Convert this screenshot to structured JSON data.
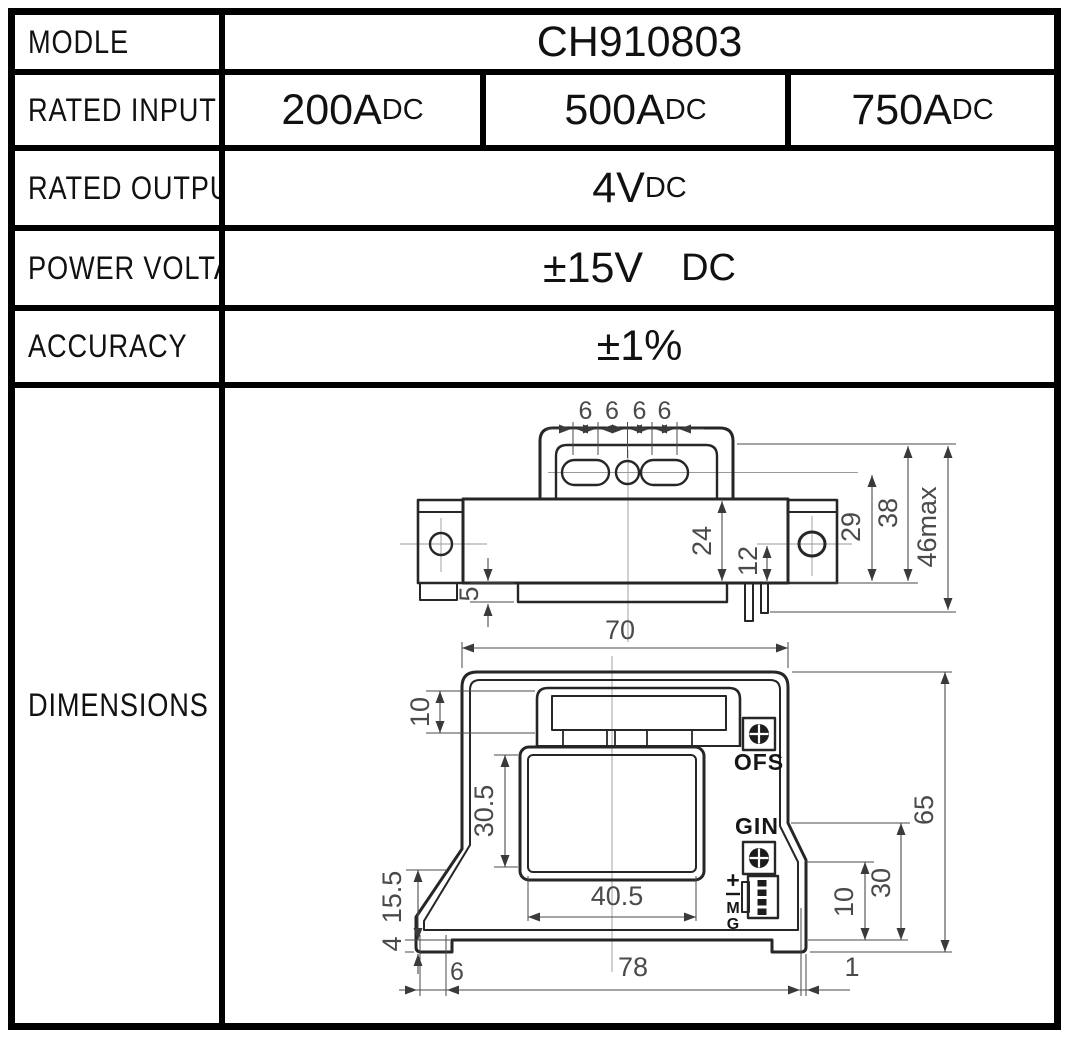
{
  "table": {
    "model_label": "MODLE",
    "model_value": "CH910803",
    "rated_input_label": "RATED INPUT",
    "rated_inputs": [
      {
        "value": "200A",
        "unit": "DC"
      },
      {
        "value": "500A",
        "unit": "DC"
      },
      {
        "value": "750A",
        "unit": "DC"
      }
    ],
    "rated_output_label": "RATED OUTPUT",
    "rated_output": {
      "value": "4V",
      "unit": "DC"
    },
    "power_voltage_label": "POWER VOLTAGE",
    "power_voltage": {
      "value": "±15V",
      "unit": "DC"
    },
    "accuracy_label": "ACCURACY",
    "accuracy_value": "±1%",
    "dimensions_label": "DIMENSIONS"
  },
  "drawing": {
    "top_view": {
      "pitch_labels": [
        "6",
        "6",
        "6",
        "6"
      ],
      "dim_body_height": "24",
      "dim_pin_offset": "12",
      "dim_hole_height": "29",
      "dim_bracket_height": "38",
      "dim_max_height": "46max",
      "dim_plate_thickness": "5"
    },
    "front_view": {
      "dim_body_width": "70",
      "dim_busbar_height": "10",
      "dim_window_height": "30.5",
      "dim_window_width": "40.5",
      "dim_left_step_height": "15.5",
      "dim_foot_height": "4",
      "dim_foot_width": "6",
      "dim_base_width": "78",
      "dim_edge_gap": "1",
      "dim_right_foot_height": "10",
      "dim_right_step_height": "30",
      "dim_total_height": "65",
      "label_offset_pot": "OFS",
      "label_gain_pot": "GIN",
      "pin_labels": [
        "+",
        "−",
        "M",
        "G"
      ]
    },
    "colors": {
      "line": "#262626",
      "dim_text": "#4a4a4a"
    }
  }
}
